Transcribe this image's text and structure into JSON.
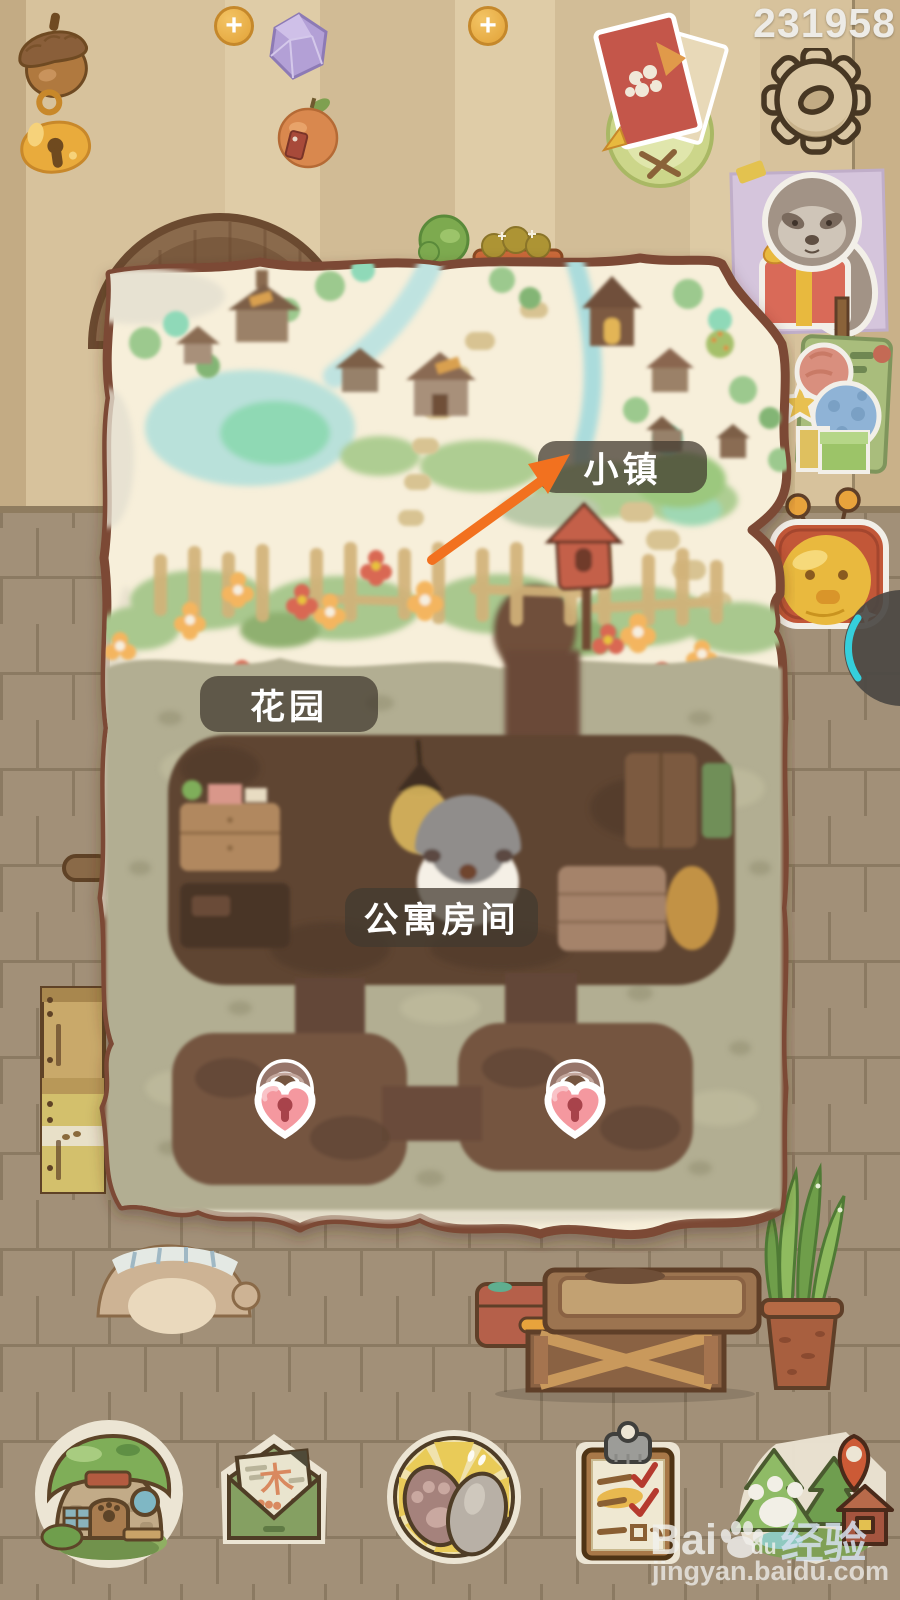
{
  "hud": {
    "plus_label": "+",
    "player_id": "231958",
    "currencies": [
      {
        "id": "acorn",
        "icon": "acorn-icon",
        "value": "3278",
        "plus": true
      },
      {
        "id": "gem",
        "icon": "gem-icon",
        "value": "49",
        "plus": true
      },
      {
        "id": "bell",
        "icon": "bell-icon",
        "value": "235",
        "plus": false
      },
      {
        "id": "orange",
        "icon": "orange-icon",
        "value": "3",
        "plus": false
      }
    ]
  },
  "labels": {
    "town": "小镇",
    "garden": "花园",
    "apartment": "公寓房间"
  },
  "mail_letter_char": "木",
  "watermark": {
    "brand_a": "Bai",
    "brand_b": "du",
    "brand_c": "经验",
    "site": "jingyan.baidu.com"
  },
  "colors": {
    "arrow": "#f2711f",
    "label_bg": "rgba(66,58,47,0.74)",
    "paper": "#f7efda",
    "lock_pink": "#f4989f",
    "wall": "#d7c29c",
    "floor": "#a29078"
  },
  "icons": {
    "top_right": [
      "gear-icon",
      "invite-icon"
    ],
    "side": [
      "sloth-photo",
      "event-sign",
      "coin-purse",
      "side-button"
    ],
    "bottom_nav": [
      "home-icon",
      "mail-icon",
      "paws-icon",
      "tasks-icon",
      "map-pin-icon"
    ],
    "map": [
      "heart-lock-icon",
      "heart-lock-icon"
    ]
  }
}
